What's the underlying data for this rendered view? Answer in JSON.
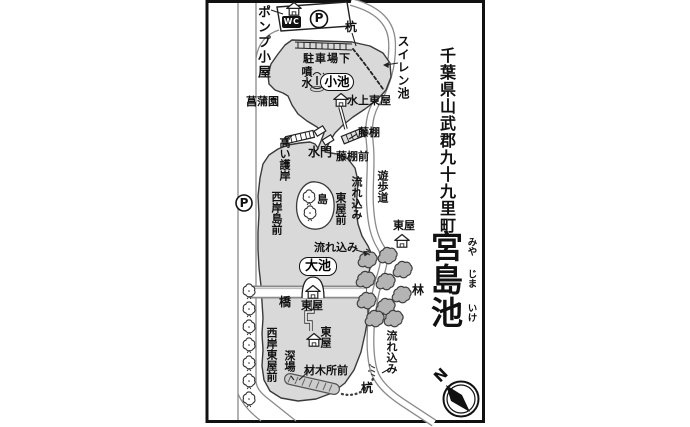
{
  "title": {
    "prefecture_line": "千葉県山武郡九十九里町",
    "pond_name": "宮島池",
    "furigana": [
      "みや",
      "じま",
      "いけ"
    ]
  },
  "compass": {
    "north": "N"
  },
  "map": {
    "labels": {
      "pump_hut": "ポンプ小屋",
      "parking_top": "P",
      "wc": "WC",
      "stake_top": "杭",
      "waterlily_pond": "スイレン池",
      "below_parking_lot": "駐車場下",
      "fountain": "噴水",
      "small_pond": "小池",
      "iris_garden": "菖蒲園",
      "water_pavilion": "水上東屋",
      "wisteria_trellis": "藤棚",
      "sluice_gate": "水門",
      "wisteria_trellis_front": "藤棚前",
      "high_revetment": "高い護岸",
      "west_shore_island_front": "西岸島前",
      "parking_left": "P",
      "island": "島",
      "inflow_upper": "流れ込み",
      "pavilion_front": "東屋前",
      "promenade": "遊歩道",
      "pavilion_east": "東屋",
      "inflow_middle": "流れ込み",
      "big_pond": "大池",
      "forest": "林",
      "bridge": "橋",
      "pavilion_bridge": "東屋",
      "pavilion_lower": "東屋",
      "west_shore_pavilion_front": "西岸東屋前",
      "deep_spot": "深場",
      "lumber_yard_front": "材木所前",
      "stake_bottom": "杭",
      "inflow_lower": "流れ込み"
    },
    "colors": {
      "water_fill": "#d9d9d9",
      "forest_fill": "#b4b4b4",
      "road_casing": "#8a8a8a",
      "ink": "#111111"
    }
  }
}
